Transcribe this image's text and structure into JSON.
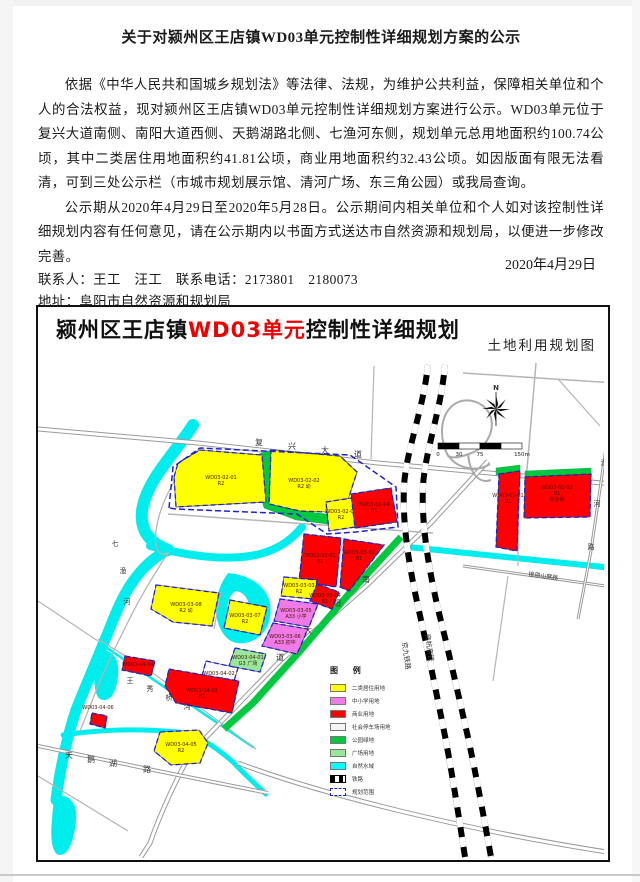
{
  "notice": {
    "title": "关于对颍州区王店镇WD03单元控制性详细规划方案的公示",
    "paragraphs": [
      "依据《中华人民共和国城乡规划法》等法律、法规，为维护公共利益，保障相关单位和个人的合法权益，现对颍州区王店镇WD03单元控制性详细规划方案进行公示。WD03单元位于复兴大道南侧、南阳大道西侧、天鹅湖路北侧、七渔河东侧，规划单元总用地面积约100.74公顷，其中二类居住用地面积约41.81公顷，商业用地面积约32.43公顷。如因版面有限无法看清，可到三处公示栏（市城市规划展示馆、清河广场、东三角公园）或我局查询。",
      "公示期从2020年4月29日至2020年5月28日。公示期间内相关单位和个人如对该控制性详细规划内容有任何意见，请在公示期内以书面方式送达市自然资源和规划局，以便进一步修改完善。"
    ],
    "contact_line": "联系人：王工　汪工　联系电话：2173801　2180073",
    "address_line": "地址：阜阳市自然资源和规划局",
    "website_line": "登陆网站:http://zrgh.fy.gov.cn/",
    "date": "2020年4月29日"
  },
  "map": {
    "title_prefix": "颍州区王店镇",
    "title_highlight": "WD03单元",
    "title_suffix": "控制性详细规划",
    "highlight_color": "#ee0000",
    "subtitle": "土地利用规划图",
    "north_label": "N",
    "scale_labels": [
      "0",
      "30",
      "75",
      "150m"
    ],
    "legend": {
      "title": "图 例",
      "items": [
        {
          "label": "二类居住用地",
          "color": "#ffff00",
          "kind": "swatch"
        },
        {
          "label": "中小学用地",
          "color": "#f07ae6",
          "kind": "swatch"
        },
        {
          "label": "商业用地",
          "color": "#ff0000",
          "kind": "swatch"
        },
        {
          "label": "社会停车场用地",
          "color": "#f4f4f4",
          "kind": "swatch"
        },
        {
          "label": "公园绿地",
          "color": "#00c93f",
          "kind": "swatch"
        },
        {
          "label": "广场用地",
          "color": "#98e89a",
          "kind": "swatch"
        },
        {
          "label": "自然水域",
          "color": "#00ffff",
          "kind": "swatch"
        },
        {
          "label": "铁路",
          "kind": "rail"
        },
        {
          "label": "规划范围",
          "kind": "boundary"
        }
      ]
    },
    "colors": {
      "yellow": "#ffff00",
      "red": "#ff0000",
      "pink": "#f07ae6",
      "lgreen": "#98e89a",
      "green": "#00c93f",
      "white": "#fafafa",
      "water": "#00eded",
      "boundary": "#2222cc",
      "label": "#4a1505",
      "road": "#9a9a9a",
      "road_minor": "#b5b5b5"
    },
    "water": [
      {
        "d": "M155,74 C135,105 108,130 104,160 C102,180 112,192 130,199",
        "w": 12
      },
      {
        "d": "M130,199 C100,214 85,244 75,269 C63,299 50,329 38,359 C28,389 22,419 18,449",
        "w": 11
      },
      {
        "d": "M112,195 C150,205 190,211 222,203 C244,197 256,186 264,176",
        "w": 8
      },
      {
        "d": "M190,222 C222,225 238,246 231,270 C226,290 202,298 190,288 C176,276 172,246 190,222 Z",
        "fill": true
      },
      {
        "d": "M198,240 C210,242 214,256 210,268 C206,278 196,280 192,272 C187,262 189,244 198,240 Z",
        "fill": true,
        "white": true
      },
      {
        "d": "M64,300 C74,298 82,308 80,325 C78,345 70,352 62,348 C54,343 54,308 64,300 Z",
        "fill": true
      },
      {
        "d": "M370,196 L575,217",
        "w": 6
      },
      {
        "d": "M25,384 C60,379 95,377 140,381 C160,384 175,394 195,411 C205,422 215,431 228,443",
        "w": 5
      },
      {
        "d": "M62,292 C105,322 150,352 215,396",
        "w": 2.5
      },
      {
        "d": "M20,445 C30,443 40,451 38,469 C36,491 30,504 22,504 C14,504 12,487 14,469 C15,457 15,449 20,445 Z",
        "fill": true
      }
    ],
    "roads": [
      {
        "d": "M0,78 L160,92 L340,112 L575,133",
        "w": 5,
        "double": true
      },
      {
        "d": "M450,110 L393,172 L328,235 L242,310 L152,403 C140,426 125,455 112,492 L103,506",
        "w": 5,
        "double": true
      },
      {
        "d": "M0,395 L120,420 L230,442",
        "w": 4,
        "double": true
      },
      {
        "d": "M200,412 C280,442 420,478 575,502",
        "w": 5,
        "double": true
      },
      {
        "d": "M425,215 L575,236",
        "w": 3,
        "double": true
      },
      {
        "d": "M573,62 L553,200 L540,268",
        "w": 3,
        "double": true
      },
      {
        "d": "M161,98 C140,120 122,150 118,180 C116,200 122,206 130,202 C115,225 100,250 88,275 C78,295 68,315 58,340 L42,380",
        "w": 1.3
      },
      {
        "d": "M130,163 L395,182",
        "w": 1.5
      },
      {
        "d": "M227,103 L233,158",
        "w": 1.2
      },
      {
        "d": "M307,187 L285,242",
        "w": 1.2
      },
      {
        "d": "M183,241 L176,278",
        "w": 1.2
      },
      {
        "d": "M60,288 L112,320 L160,355 L218,398",
        "w": 1.3
      },
      {
        "d": "M425,22 L577,32",
        "w": 1.5
      },
      {
        "d": "M498,12 L488,130",
        "w": 1.5
      },
      {
        "d": "M520,28 L562,75",
        "w": 1.2
      },
      {
        "d": "M470,225 L455,330",
        "w": 1.2
      },
      {
        "d": "M0,250 L60,290",
        "w": 1.2
      },
      {
        "d": "M0,425 L90,480",
        "w": 1.2
      },
      {
        "d": "M336,15 L333,108",
        "w": 1.2
      },
      {
        "d": "M480,130 L480,215",
        "w": 1.2
      }
    ],
    "interchange": [
      "M410,105 C394,72 412,42 438,51 C462,60 458,94 431,103 C420,107 413,107 410,105",
      "M410,104 C418,117 438,122 452,113",
      "M430,103 C432,124 442,133 453,129"
    ],
    "railways": [
      "M390,14 C385,60 368,100 366,135 C364,175 372,220 381,260 C390,300 398,340 406,380 C414,420 420,460 427,506",
      "M407,14 C403,60 387,100 385,135 C383,175 391,220 401,262 C411,302 420,342 429,382 C438,422 445,462 453,506"
    ],
    "green_fills": [
      "221,103 233,99 231,153 262,160 306,165 304,175 258,169 226,157 218,128",
      "458,117 482,114 482,121 458,124",
      "487,120 553,117 553,124 487,127"
    ],
    "green_strokes": [
      {
        "d": "M363,186 L310,244 L262,300 L215,352 L186,378",
        "w": 7
      }
    ],
    "cluster_outline": "131,157 135,116 162,97 312,104 358,136 360,176 318,181 289,183 259,163 138,158",
    "parcels": [
      {
        "id": "WD03-02-01",
        "c": "yellow",
        "pts": "136,126 140,112 162,99 224,104 228,151 138,156",
        "lx": 183,
        "ly": 128,
        "lines": [
          "WD03-02-01",
          "R2"
        ]
      },
      {
        "id": "WD03-02-02",
        "c": "yellow",
        "pts": "233,99 302,105 319,121 309,152 288,161 262,160 231,153",
        "lx": 266,
        "ly": 131,
        "lines": [
          "WD03-02-02",
          "R2 幼"
        ]
      },
      {
        "id": "WD03-02-03",
        "c": "yellow",
        "pts": "288,151 314,147 317,176 291,180",
        "lx": 303,
        "ly": 162,
        "lines": [
          "WD03-02-03",
          "R2"
        ]
      },
      {
        "id": "WD03-02-04",
        "c": "red",
        "pts": "313,143 353,137 359,171 317,177",
        "lx": 336,
        "ly": 155,
        "lines": [
          "WD03-02-04",
          "B1"
        ]
      },
      {
        "id": "WD03-03-01",
        "c": "red",
        "pts": "266,183 303,187 298,236 261,230",
        "lx": 282,
        "ly": 206,
        "lines": [
          "WD03-03-01",
          "B1"
        ]
      },
      {
        "id": "WD03-03-02",
        "c": "red",
        "pts": "306,188 346,194 311,240 302,236",
        "lx": 321,
        "ly": 203,
        "lines": [
          "WD03-03-02",
          "B1"
        ]
      },
      {
        "id": "WD03-03-03",
        "c": "yellow",
        "pts": "246,226 279,229 276,248 243,245",
        "lx": 261,
        "ly": 236,
        "lines": [
          "WD03-03-03",
          "R2"
        ]
      },
      {
        "id": "WD03-03-04",
        "c": "red",
        "pts": "279,233 301,241 294,258 272,250",
        "lx": 287,
        "ly": 246,
        "lines": [
          "WD03-03-04",
          "B1"
        ]
      },
      {
        "id": "WD03-03-05",
        "c": "pink",
        "pts": "242,248 280,253 271,276 236,270",
        "lx": 258,
        "ly": 261,
        "lines": [
          "WD03-03-05",
          "A33 小学"
        ]
      },
      {
        "id": "WD03-03-06",
        "c": "pink",
        "pts": "235,272 270,278 259,303 224,295",
        "lx": 247,
        "ly": 287,
        "lines": [
          "WD03-03-06",
          "A33 初中"
        ]
      },
      {
        "id": "WD03-03-08",
        "c": "yellow",
        "pts": "118,234 181,242 174,275 135,271 113,258",
        "lx": 148,
        "ly": 255,
        "lines": [
          "WD03-03-08",
          "R2 幼"
        ]
      },
      {
        "id": "WD03-03-07",
        "c": "yellow",
        "pts": "192,249 229,256 222,284 186,277",
        "lx": 207,
        "ly": 266,
        "lines": [
          "WD03-03-07",
          "R2"
        ]
      },
      {
        "id": "WD03-04-01",
        "c": "lgreen",
        "pts": "197,297 228,303 222,321 191,315",
        "lx": 210,
        "ly": 308,
        "lines": [
          "WD03-04-01",
          "G3 广场"
        ]
      },
      {
        "id": "WD03-04-02",
        "c": "white",
        "pts": "168,310 200,317 193,340 162,332",
        "lx": 181,
        "ly": 324,
        "lines": [
          "WD03-04-02",
          "S42"
        ]
      },
      {
        "id": "WD03-04-03",
        "c": "red",
        "pts": "131,318 201,330 194,362 138,352 127,335",
        "lx": 164,
        "ly": 341,
        "lines": [
          "WD03-04-03",
          "B1"
        ]
      },
      {
        "id": "WD03-04-04",
        "c": "red",
        "pts": "87,305 117,310 113,325 84,319",
        "lx": 100,
        "ly": 315,
        "lines": [
          "WD03-04-04"
        ]
      },
      {
        "id": "WD03-04-05",
        "c": "yellow",
        "pts": "122,381 161,379 170,392 162,412 133,414 116,400",
        "lx": 143,
        "ly": 395,
        "lines": [
          "WD03-04-05",
          "R2"
        ]
      },
      {
        "id": "WD03-04-06",
        "c": "red",
        "pts": "54,362 69,365 67,377 52,373",
        "lx": 60,
        "ly": 358,
        "lines": [
          "WD03-04-06"
        ]
      },
      {
        "id": "WD03-01-01",
        "c": "red",
        "pts": "461,123 482,120 479,200 458,196",
        "lx": 470,
        "ly": 146,
        "lines": [
          "WD03-01-01",
          "B1"
        ]
      },
      {
        "id": "WD03-01-02",
        "c": "red",
        "pts": "487,126 553,123 552,166 486,167",
        "lx": 519,
        "ly": 138,
        "lines": [
          "WD03-01-02",
          "B1",
          "商业街"
        ]
      }
    ],
    "labels": [
      {
        "t": "复",
        "x": 221,
        "y": 94,
        "s": 8
      },
      {
        "t": "兴",
        "x": 254,
        "y": 98,
        "s": 8
      },
      {
        "t": "大",
        "x": 287,
        "y": 102,
        "s": 8
      },
      {
        "t": "道",
        "x": 320,
        "y": 106,
        "s": 8
      },
      {
        "t": "南",
        "x": 328,
        "y": 231,
        "s": 8
      },
      {
        "t": "阳",
        "x": 299,
        "y": 255,
        "s": 8
      },
      {
        "t": "大",
        "x": 270,
        "y": 282,
        "s": 8
      },
      {
        "t": "道",
        "x": 242,
        "y": 309,
        "s": 8
      },
      {
        "t": "天",
        "x": 31,
        "y": 407,
        "s": 8
      },
      {
        "t": "鹅",
        "x": 53,
        "y": 411,
        "s": 8
      },
      {
        "t": "湖",
        "x": 75,
        "y": 415,
        "s": 8
      },
      {
        "t": "路",
        "x": 109,
        "y": 421,
        "s": 8
      },
      {
        "t": "王",
        "x": 92,
        "y": 332,
        "s": 7
      },
      {
        "t": "秀",
        "x": 112,
        "y": 340,
        "s": 7
      },
      {
        "t": "桥",
        "x": 131,
        "y": 349,
        "s": 7
      },
      {
        "t": "沟",
        "x": 149,
        "y": 358,
        "s": 7
      },
      {
        "t": "七",
        "x": 569,
        "y": 80,
        "s": 7
      },
      {
        "t": "渔",
        "x": 566,
        "y": 114,
        "s": 7
      },
      {
        "t": "河",
        "x": 559,
        "y": 155,
        "s": 7
      },
      {
        "t": "路",
        "x": 553,
        "y": 198,
        "s": 7
      },
      {
        "t": "七",
        "x": 77,
        "y": 195,
        "s": 7
      },
      {
        "t": "渔",
        "x": 85,
        "y": 222,
        "s": 7
      },
      {
        "t": "河",
        "x": 89,
        "y": 253,
        "s": 7
      },
      {
        "t": "接邵山窝路",
        "x": 505,
        "y": 227,
        "s": 6,
        "r": 8
      },
      {
        "t": "京九铁路",
        "x": 366,
        "y": 305,
        "s": 7,
        "r": 82
      },
      {
        "t": "商杭高铁",
        "x": 389,
        "y": 297,
        "s": 7,
        "r": 82
      },
      {
        "t": "N",
        "x": 458,
        "y": 39,
        "s": 7,
        "b": 1
      }
    ]
  }
}
